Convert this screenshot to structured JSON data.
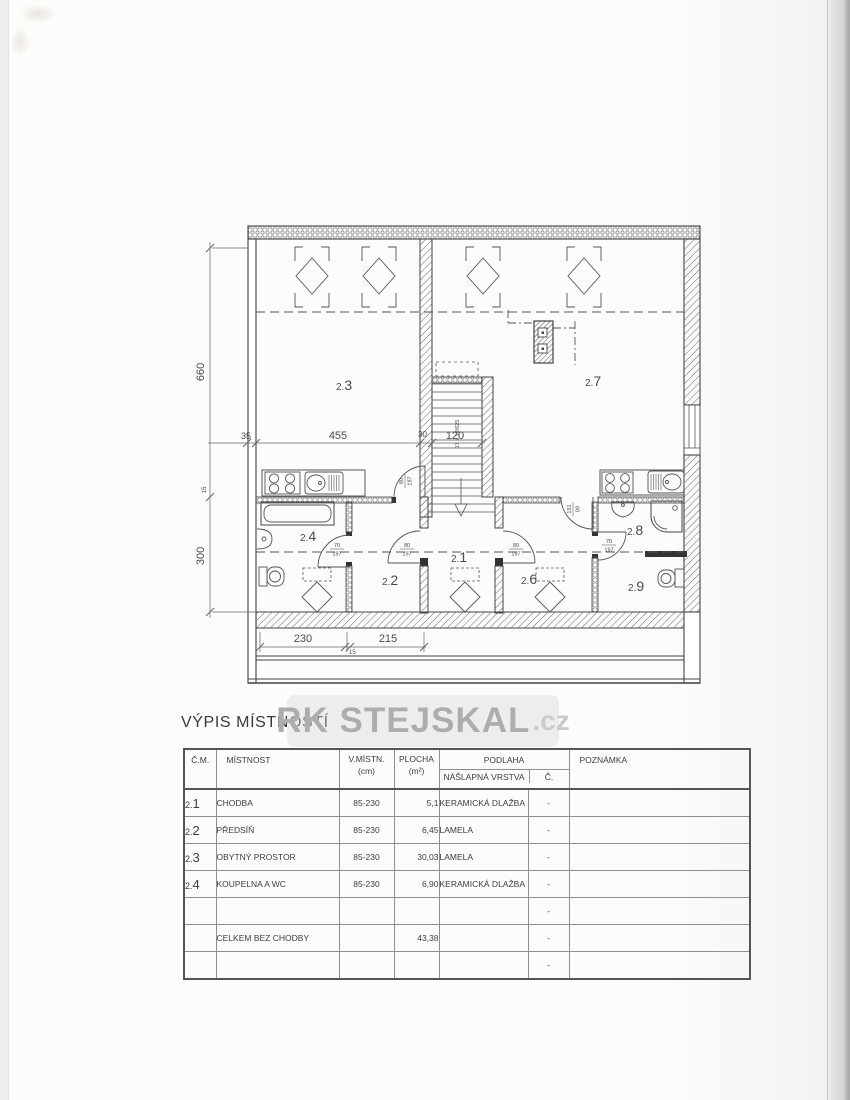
{
  "title": "VÝPIS MÍSTNOSTÍ",
  "watermark": {
    "main": "RK STEJSKAL",
    "suffix": ".cz"
  },
  "plan": {
    "rooms": [
      {
        "prefix": "2.",
        "digit": "3"
      },
      {
        "prefix": "2.",
        "digit": "7"
      },
      {
        "prefix": "2.",
        "digit": "4"
      },
      {
        "prefix": "2.",
        "digit": "2"
      },
      {
        "prefix": "2.",
        "digit": "1"
      },
      {
        "prefix": "2.",
        "digit": "6"
      },
      {
        "prefix": "2.",
        "digit": "8"
      },
      {
        "prefix": "2.",
        "digit": "9"
      }
    ],
    "dims": {
      "left_upper": "660",
      "left_lower": "300",
      "left_small": "15",
      "top_a": "35",
      "top_b": "455",
      "top_c": "30",
      "top_d": "120",
      "bottom_a": "230",
      "bottom_small": "15",
      "bottom_b": "215"
    },
    "stairs_label": "17 x 19/625",
    "doors": {
      "kitchen_left": {
        "top": "80",
        "bottom": "197"
      },
      "room24": {
        "top": "70",
        "bottom": "197"
      },
      "room22": {
        "top": "80",
        "bottom": "197"
      },
      "room26": {
        "top": "80",
        "bottom": "197"
      },
      "room29": {
        "top": "70",
        "bottom": "197"
      },
      "room28": {
        "top": "151",
        "bottom": "09"
      }
    }
  },
  "table": {
    "headers": {
      "num": "Č.M.",
      "room": "MÍSTNOST",
      "height": "V.MÍSTN.",
      "height_unit": "(cm)",
      "area": "PLOCHA",
      "area_unit": "(m²)",
      "floor": "PODLAHA",
      "layer": "NÁŠLAPNÁ VRSTVA",
      "c": "Č.",
      "note": "POZNÁMKA"
    },
    "rows": [
      {
        "num_prefix": "2.",
        "num_digit": "1",
        "name": "CHODBA",
        "height": "85-230",
        "area": "5,1",
        "floor": "KERAMICKÁ DLAŽBA",
        "c": "-",
        "note": ""
      },
      {
        "num_prefix": "2.",
        "num_digit": "2",
        "name": "PŘEDSÍŇ",
        "height": "85-230",
        "area": "6,45",
        "floor": "LAMELA",
        "c": "-",
        "note": ""
      },
      {
        "num_prefix": "2.",
        "num_digit": "3",
        "name": "OBYTNÝ PROSTOR",
        "height": "85-230",
        "area": "30,03",
        "floor": "LAMELA",
        "c": "-",
        "note": ""
      },
      {
        "num_prefix": "2.",
        "num_digit": "4",
        "name": "KOUPELNA A WC",
        "height": "85-230",
        "area": "6,90",
        "floor": "KERAMICKÁ DLAŽBA",
        "c": "-",
        "note": ""
      },
      {
        "num_prefix": "",
        "num_digit": "",
        "name": "",
        "height": "",
        "area": "",
        "floor": "",
        "c": "-",
        "note": ""
      },
      {
        "num_prefix": "",
        "num_digit": "",
        "name": "CELKEM BEZ CHODBY",
        "height": "",
        "area": "43,38",
        "floor": "",
        "c": "-",
        "note": ""
      },
      {
        "num_prefix": "",
        "num_digit": "",
        "name": "",
        "height": "",
        "area": "",
        "floor": "",
        "c": "-",
        "note": ""
      }
    ]
  }
}
